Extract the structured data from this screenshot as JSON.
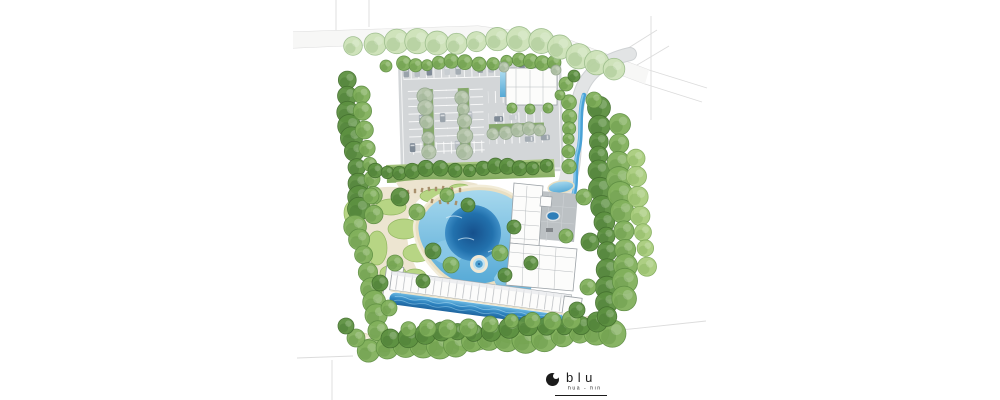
{
  "logo": {
    "brand": "blu",
    "location": "hua - hin",
    "mark": "crescent-moon-circle-icon"
  },
  "site": {
    "features": [
      "street-tree-row",
      "surface-parking",
      "parking-tree-medians",
      "entrance-pavilion",
      "access-road",
      "landscape-stream",
      "clubhouse",
      "drop-off-court",
      "court-fountain",
      "lagoon-pool",
      "jacuzzi-island",
      "lawn-mounds",
      "sun-deck-loungers",
      "residential-block",
      "lap-pool",
      "winding-garden-path",
      "perimeter-tree-buffer",
      "survey-boundary-lines"
    ]
  },
  "colors": {
    "background": "#ffffff",
    "survey_line": "#dcdcdc",
    "asphalt": "#d3d6d8",
    "paver_court": "#bcc1c4",
    "building_fill": "#fcfcfb",
    "building_outline": "#9aa0a5",
    "lagoon_deep": "#17548f",
    "lagoon_shallow": "#8fcbe8",
    "lap_pool": "#2e84c0",
    "stream": "#49a2d6",
    "sand": "#ece4cf",
    "lawn": "#b7d584",
    "logo_ink": "#1b1b1b",
    "car_colors": [
      "#9aa3ab",
      "#b8bec4",
      "#7f8a96",
      "#c9ced2",
      "#a5adb4"
    ],
    "tree_palettes": {
      "pale": {
        "base": "#cde2b8",
        "edge": "#9cbd8b",
        "shade": "#a3c48e"
      },
      "gray": {
        "base": "#b7c6ad",
        "edge": "#93a78c",
        "shade": "#9cb194"
      },
      "light": {
        "base": "#a9cd7d",
        "edge": "#83ad5b",
        "shade": "#8db863"
      },
      "mid": {
        "base": "#82b15c",
        "edge": "#5f8f43",
        "shade": "#699a4a"
      },
      "dark": {
        "base": "#5d9141",
        "edge": "#44702f",
        "shade": "#4b7b35"
      }
    }
  },
  "plan": {
    "tree_belts": [
      {
        "x1": 353,
        "y1": 44,
        "x2": 541,
        "y2": 40,
        "n": 10,
        "r": 11,
        "p": "pale",
        "layer": "street"
      },
      {
        "x1": 558,
        "y1": 46,
        "x2": 614,
        "y2": 71,
        "n": 4,
        "r": 11,
        "p": "pale",
        "layer": "street"
      },
      {
        "x1": 402,
        "y1": 64,
        "x2": 556,
        "y2": 61,
        "n": 13,
        "r": 6.5,
        "p": "mid",
        "layer": "trees"
      },
      {
        "x1": 347,
        "y1": 82,
        "x2": 359,
        "y2": 210,
        "n": 10,
        "r": 10,
        "p": "dark",
        "layer": "trees"
      },
      {
        "x1": 363,
        "y1": 96,
        "x2": 373,
        "y2": 214,
        "n": 8,
        "r": 8,
        "p": "mid",
        "layer": "trees"
      },
      {
        "x1": 357,
        "y1": 226,
        "x2": 379,
        "y2": 332,
        "n": 8,
        "r": 10,
        "p": "mid",
        "layer": "trees"
      },
      {
        "x1": 369,
        "y1": 349,
        "x2": 613,
        "y2": 332,
        "n": 15,
        "r": 12,
        "p": "mid",
        "layer": "trees"
      },
      {
        "x1": 389,
        "y1": 337,
        "x2": 597,
        "y2": 323,
        "n": 13,
        "r": 9,
        "p": "dark",
        "layer": "trees"
      },
      {
        "x1": 597,
        "y1": 108,
        "x2": 609,
        "y2": 318,
        "n": 14,
        "r": 10,
        "p": "dark",
        "layer": "trees"
      },
      {
        "x1": 619,
        "y1": 126,
        "x2": 625,
        "y2": 300,
        "n": 11,
        "r": 11,
        "p": "mid",
        "layer": "trees"
      },
      {
        "x1": 637,
        "y1": 160,
        "x2": 645,
        "y2": 268,
        "n": 7,
        "r": 9,
        "p": "light",
        "layer": "trees"
      },
      {
        "x1": 427,
        "y1": 96,
        "x2": 427,
        "y2": 150,
        "n": 5,
        "r": 7,
        "p": "gray",
        "layer": "trees"
      },
      {
        "x1": 463,
        "y1": 96,
        "x2": 463,
        "y2": 150,
        "n": 5,
        "r": 7,
        "p": "gray",
        "layer": "trees"
      },
      {
        "x1": 492,
        "y1": 132,
        "x2": 540,
        "y2": 130,
        "n": 5,
        "r": 6,
        "p": "gray",
        "layer": "trees"
      },
      {
        "x1": 567,
        "y1": 102,
        "x2": 571,
        "y2": 166,
        "n": 6,
        "r": 6.5,
        "p": "mid",
        "layer": "trees"
      },
      {
        "x1": 374,
        "y1": 172,
        "x2": 548,
        "y2": 166,
        "n": 14,
        "r": 7,
        "p": "dark",
        "layer": "trees"
      },
      {
        "x1": 409,
        "y1": 331,
        "x2": 571,
        "y2": 318,
        "n": 9,
        "r": 8,
        "p": "mid",
        "layer": "trees"
      }
    ],
    "tree_scatter": [
      [
        400,
        197,
        9,
        "dark"
      ],
      [
        417,
        212,
        8,
        "mid"
      ],
      [
        433,
        251,
        8,
        "dark"
      ],
      [
        451,
        265,
        8,
        "mid"
      ],
      [
        468,
        205,
        7,
        "dark"
      ],
      [
        500,
        253,
        8,
        "mid"
      ],
      [
        514,
        227,
        7,
        "dark"
      ],
      [
        395,
        263,
        8,
        "mid"
      ],
      [
        423,
        281,
        7,
        "dark"
      ],
      [
        447,
        195,
        7,
        "mid"
      ],
      [
        505,
        275,
        7,
        "dark"
      ],
      [
        584,
        197,
        8,
        "mid"
      ],
      [
        590,
        242,
        9,
        "dark"
      ],
      [
        588,
        287,
        8,
        "mid"
      ],
      [
        531,
        263,
        7,
        "dark"
      ],
      [
        566,
        236,
        7,
        "mid"
      ],
      [
        577,
        310,
        8,
        "dark"
      ],
      [
        371,
        196,
        8,
        "mid"
      ],
      [
        380,
        283,
        8,
        "dark"
      ],
      [
        389,
        308,
        8,
        "mid"
      ],
      [
        504,
        67,
        5,
        "gray"
      ],
      [
        556,
        70,
        5,
        "gray"
      ],
      [
        560,
        95,
        5,
        "mid"
      ],
      [
        512,
        108,
        5,
        "mid"
      ],
      [
        530,
        109,
        5,
        "mid"
      ],
      [
        548,
        108,
        5,
        "mid"
      ],
      [
        594,
        100,
        8,
        "mid"
      ],
      [
        566,
        84,
        7,
        "mid"
      ],
      [
        574,
        76,
        6,
        "dark"
      ],
      [
        356,
        338,
        9,
        "mid"
      ],
      [
        346,
        326,
        8,
        "dark"
      ],
      [
        386,
        66,
        6,
        "mid"
      ]
    ],
    "cars": [
      [
        406,
        73,
        0
      ],
      [
        417,
        73,
        0
      ],
      [
        429,
        72,
        0
      ],
      [
        447,
        72,
        0
      ],
      [
        458,
        72,
        0
      ],
      [
        480,
        71,
        0
      ],
      [
        491,
        71,
        0
      ],
      [
        522,
        70,
        0
      ],
      [
        533,
        70,
        0
      ],
      [
        420,
        120,
        0
      ],
      [
        441,
        119,
        0
      ],
      [
        468,
        118,
        0
      ],
      [
        497,
        122,
        90
      ],
      [
        512,
        121,
        90
      ],
      [
        527,
        143,
        90
      ],
      [
        543,
        142,
        90
      ],
      [
        455,
        147,
        0
      ],
      [
        410,
        148,
        0
      ]
    ],
    "lawn_mounds": [
      [
        391,
        207,
        15,
        8
      ],
      [
        404,
        229,
        16,
        10
      ],
      [
        377,
        248,
        10,
        17
      ],
      [
        417,
        253,
        14,
        9
      ],
      [
        437,
        196,
        17,
        7
      ],
      [
        460,
        189,
        11,
        5
      ],
      [
        393,
        273,
        13,
        8
      ],
      [
        415,
        276,
        11,
        7
      ],
      [
        352,
        213,
        8,
        12
      ]
    ],
    "berms": [
      [
        380,
        345,
        22,
        7
      ],
      [
        428,
        342,
        26,
        8
      ],
      [
        470,
        345,
        18,
        6
      ],
      [
        520,
        337,
        22,
        7
      ],
      [
        570,
        327,
        20,
        7
      ],
      [
        600,
        321,
        14,
        6
      ]
    ],
    "loungers": [
      [
        408,
        192
      ],
      [
        415,
        191
      ],
      [
        422,
        190
      ],
      [
        429,
        189
      ],
      [
        436,
        189
      ],
      [
        443,
        188
      ],
      [
        452,
        189
      ],
      [
        460,
        190
      ],
      [
        432,
        201
      ],
      [
        440,
        202
      ],
      [
        448,
        202
      ],
      [
        456,
        203
      ]
    ]
  }
}
